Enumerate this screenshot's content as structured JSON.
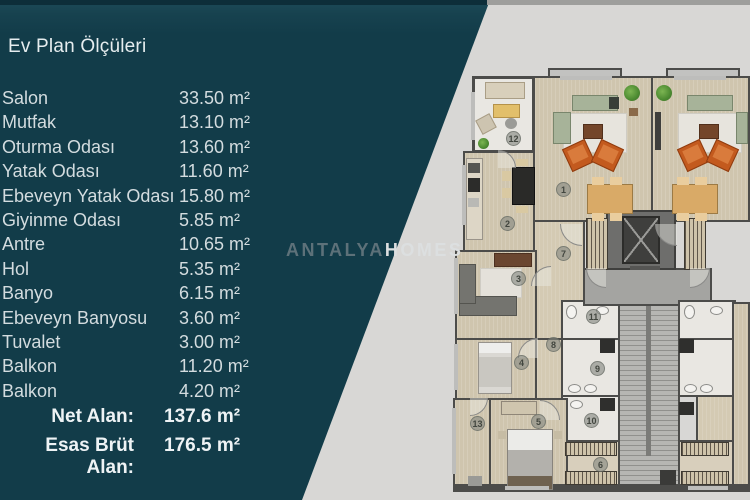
{
  "panel": {
    "title": "Ev Plan Ölçüleri",
    "rooms": [
      {
        "name": "Salon",
        "area": "33.50 m²"
      },
      {
        "name": "Mutfak",
        "area": "13.10 m²"
      },
      {
        "name": "Oturma Odası",
        "area": "13.60 m²"
      },
      {
        "name": "Yatak Odası",
        "area": "11.60 m²"
      },
      {
        "name": "Ebeveyn Yatak Odası",
        "area": "15.80 m²"
      },
      {
        "name": "Giyinme Odası",
        "area": "5.85 m²"
      },
      {
        "name": "Antre",
        "area": "10.65 m²"
      },
      {
        "name": "Hol",
        "area": "5.35 m²"
      },
      {
        "name": "Banyo",
        "area": "6.15 m²"
      },
      {
        "name": "Ebeveyn Banyosu",
        "area": "3.60 m²"
      },
      {
        "name": "Tuvalet",
        "area": "3.00 m²"
      },
      {
        "name": "Balkon",
        "area": "11.20 m²"
      },
      {
        "name": "Balkon",
        "area": "4.20 m²"
      }
    ],
    "totals": [
      {
        "label": "Net Alan:",
        "value": "137.6  m²"
      },
      {
        "label": "Esas Brüt Alan:",
        "value": "176.5  m²"
      }
    ]
  },
  "watermark": {
    "part1": "ANTALYA",
    "part2": "HOMES"
  },
  "plan": {
    "room_numbers": [
      "1",
      "2",
      "3",
      "4",
      "5",
      "6",
      "7",
      "8",
      "9",
      "10",
      "11",
      "12",
      "13"
    ]
  },
  "colors": {
    "teal_panel": "#123c49",
    "background": "#d8d7d5",
    "floor_beige": "#cfc5ae",
    "wall_gray": "#4c4c4a",
    "armchair_orange": "#c35a1e",
    "sofa_sage": "#a7b399",
    "text_light": "#d3dcdf"
  }
}
